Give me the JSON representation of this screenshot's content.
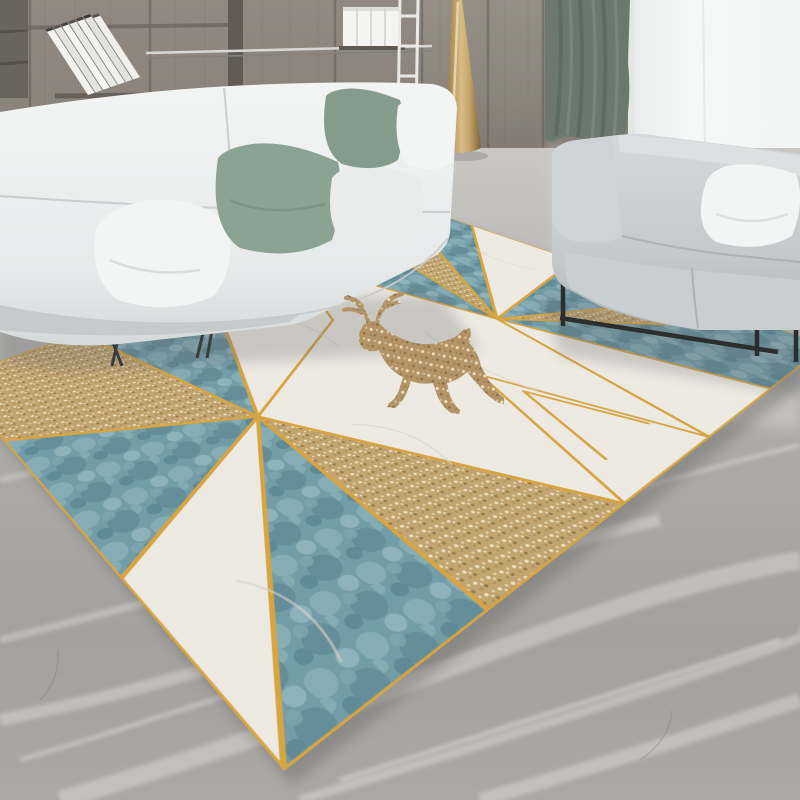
{
  "scene": {
    "description": "Modern living room product photo: geometric teal, cream and gold deer rug on gray marble floor",
    "objects": {
      "wall_unit": "wood panel wall with shelving",
      "leaning_books": "row of leaning white books",
      "standing_books": "stack of upright white books",
      "metal_rail": "shelf metal rail",
      "ladder": "white ladder rack",
      "window": "bright window light",
      "curtain": "sage green curtain",
      "floor": "gray marble floor",
      "white_sofa": "white fabric sofa with cushions",
      "gray_loveseat": "gray loveseat with black metal frame",
      "floor_lamp": "gold cone floor lamp",
      "rug": "geometric rug with teal, cream and gold triangles",
      "deer": "gold speckled leaping deer motif"
    }
  },
  "palette": {
    "wall_wood": "#918a81",
    "wall_wood_dark": "#7b746c",
    "wall_wood_light": "#9c958c",
    "shelf_dark": "#6b645c",
    "window_light": "#f4f6f5",
    "curtain_green": "#6b786e",
    "curtain_fold": "#59665c",
    "floor_light": "#c8c6c2",
    "floor_mid": "#a6a4a1",
    "floor_dark": "#8f8d8a",
    "vein_white": "#e9e7e3",
    "sofa_white": "#edf0f0",
    "sofa_white_shade": "#d7dbdb",
    "sofa_gray": "#c8cdcf",
    "sofa_gray_shade": "#aab1b4",
    "pillow_green": "#8ca293",
    "pillow_green_2": "#859c8c",
    "pillow_white": "#f3f5f4",
    "metal_black": "#2b2d2f",
    "lamp_gold": "#c2a269",
    "lamp_gold_dark": "#8f7344",
    "rug_white": "#f0ede5",
    "rug_teal": "#6f9ca7",
    "rug_teal_light": "#9cc0c6",
    "rug_teal_dark": "#527e8b",
    "rug_gold_base": "#c3a46d",
    "rug_gold_dot_light": "#f3e8cc",
    "rug_gold_dot_dark": "#8f7344",
    "rug_line_gold": "#d9a43c",
    "deer_gold": "#b49467",
    "shadow": "#5f6266"
  }
}
